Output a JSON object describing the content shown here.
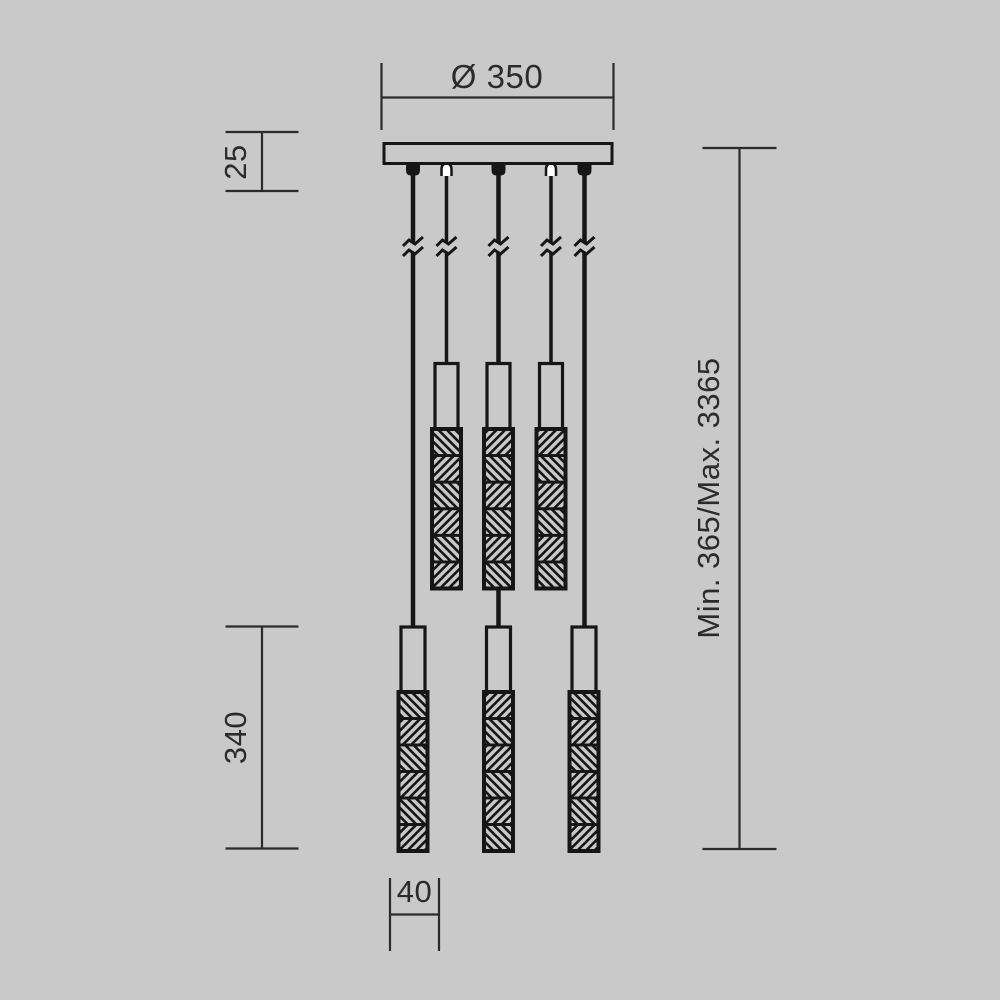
{
  "dimensions": {
    "canopy_diameter": "Ø 350",
    "canopy_height": "25",
    "pendant_length": "340",
    "pendant_width": "40",
    "suspension_height": "Min. 365/Max. 3365"
  },
  "colors": {
    "background": "#c9c9c9",
    "fixture_line": "#161616",
    "dimension_line": "#2b2b2b",
    "hollow_grip_fill": "#ffffff"
  },
  "icons": {
    "cord_break_icon": "≈"
  }
}
